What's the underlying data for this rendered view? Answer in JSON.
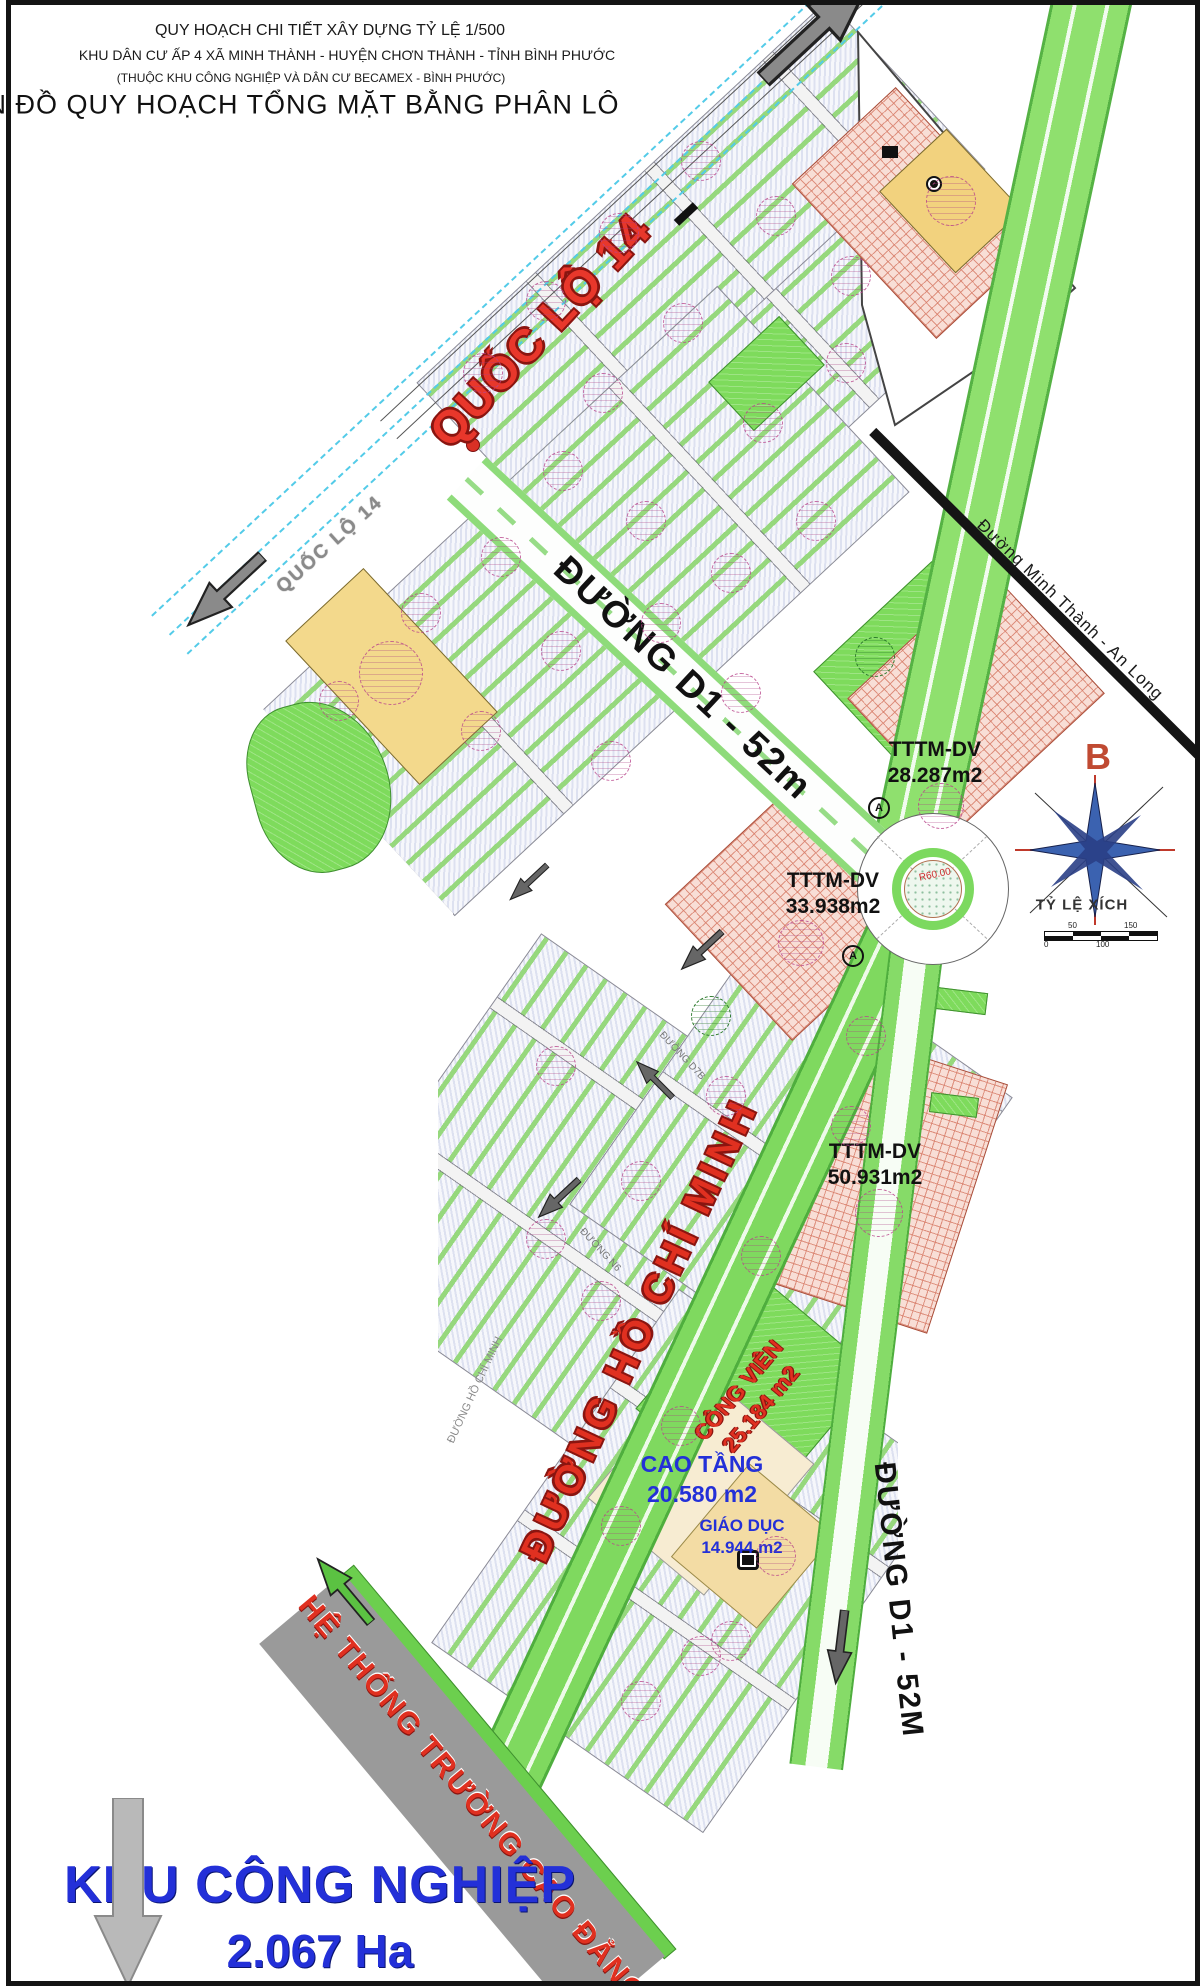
{
  "title_block": {
    "line1": "QUY HOẠCH CHI TIẾT XÂY DỰNG TỶ LỆ 1/500",
    "line2": "KHU DÂN CƯ  ẤP 4  XÃ MINH THÀNH - HUYỆN CHƠN THÀNH - TỈNH BÌNH PHƯỚC",
    "line3": "(THUỘC KHU CÔNG NGHIỆP VÀ DÂN CƯ BECAMEX - BÌNH PHƯỚC)",
    "line4": "BẢN ĐỒ QUY HOẠCH TỔNG MẶT BẰNG PHÂN LÔ"
  },
  "roads": {
    "ql14_main": "QUỐC LỘ 14",
    "ql14_small": "QUỐC LỘ 14",
    "d1_upper": "ĐƯỜNG D1 - 52m",
    "d1_lower": "ĐƯỜNG D1 - 52M",
    "minh_thanh": "Đường Minh Thành - An Long",
    "ho_chi_minh": "ĐƯỜNG HỒ CHÍ MINH",
    "ho_chi_minh_small": "ĐƯỜNG HỒ CHÍ MINH",
    "n6": "ĐƯỜNG N6",
    "d7b": "ĐƯỜNG D7B",
    "roundabout_radius": "R60.00"
  },
  "parcels": {
    "tttm1": {
      "name": "TTTM-DV",
      "area": "28.287m2"
    },
    "tttm2": {
      "name": "TTTM-DV",
      "area": "33.938m2"
    },
    "tttm3": {
      "name": "TTTM-DV",
      "area": "50.931m2"
    },
    "cong_vien": {
      "name": "CÔNG VIÊN",
      "area": "25.184 m2"
    },
    "cao_tang": {
      "name": "CAO TẦNG",
      "area": "20.580 m2"
    },
    "giao_duc": {
      "name": "GIÁO DỤC",
      "area": "14.944 m2"
    }
  },
  "annotations": {
    "college": "HỆ THỐNG TRƯỜNG CAO ĐẲNG",
    "industrial_zone": "KHU CÔNG NGHIỆP",
    "industrial_area": "2.067 Ha",
    "compass_north": "B",
    "scale_label": "TỶ LỆ XÍCH",
    "scale_ticks": [
      "0",
      "50",
      "100",
      "150"
    ]
  },
  "colors": {
    "road_green": "#7fd95f",
    "parcel_green": "#7edb5c",
    "parcel_tan": "#f2d27e",
    "tttm_pink": "#f8ded6",
    "highlight_red": "#e8372b",
    "label_blue": "#2330d8",
    "bar_gray": "#9a9a9a"
  }
}
